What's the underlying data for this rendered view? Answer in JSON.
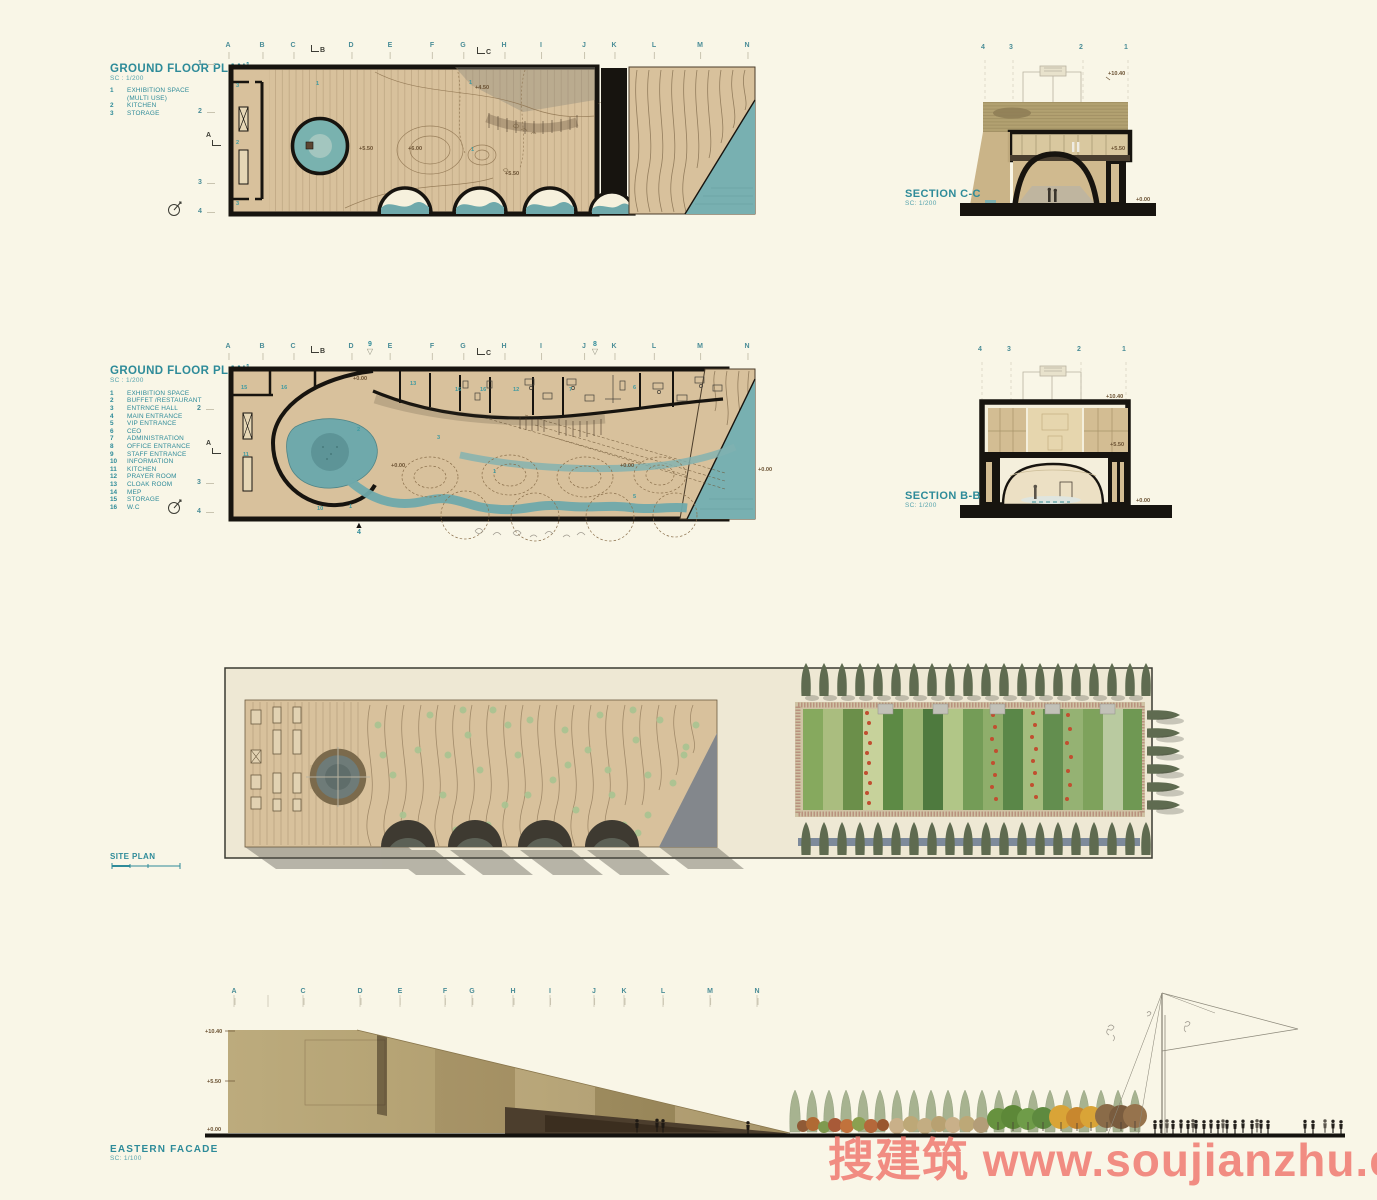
{
  "watermark": {
    "text": "搜建筑 www.soujianzhu.cn",
    "color": "#f0756c"
  },
  "grid": {
    "plan_letters": [
      "A",
      "B",
      "C",
      "D",
      "E",
      "F",
      "G",
      "H",
      "I",
      "J",
      "K",
      "L",
      "M",
      "N"
    ],
    "facade_letters": [
      "A",
      "C",
      "D",
      "E",
      "F",
      "G",
      "H",
      "I",
      "J",
      "K",
      "L",
      "M",
      "N"
    ]
  },
  "plan_upper": {
    "title": "GROUND FLOOR PLAN",
    "title_sup": "1",
    "scale": "SC : 1/200",
    "legend": [
      {
        "num": "1",
        "label": "EXHIBITION SPACE"
      },
      {
        "num": "",
        "label": "(MULTI USE)"
      },
      {
        "num": "2",
        "label": "KITCHEN"
      },
      {
        "num": "3",
        "label": "STORAGE"
      }
    ],
    "rows": [
      "1",
      "2",
      "3",
      "4"
    ],
    "room_labels": [
      "3",
      "2",
      "3",
      "1",
      "1",
      "1"
    ],
    "level_labels": [
      "+5.50",
      "+6.00",
      "+4.50",
      "+5.50"
    ],
    "markers": {
      "a": "A",
      "b": "B",
      "c": "C"
    }
  },
  "section_cc": {
    "title": "SECTION C-C",
    "scale": "SC: 1/200",
    "grid_numbers": [
      "4",
      "3",
      "2",
      "1"
    ],
    "levels": [
      "+10.40",
      "+5.50",
      "+0.00"
    ]
  },
  "plan_ground": {
    "title": "GROUND FLOOR PLAN",
    "title_sup": "1",
    "scale": "SC : 1/200",
    "legend": [
      {
        "num": "1",
        "label": "EXHIBITION SPACE"
      },
      {
        "num": "2",
        "label": "BUFFET /RESTAURANT"
      },
      {
        "num": "3",
        "label": "ENTRNCE HALL"
      },
      {
        "num": "4",
        "label": "MAIN ENTRANCE"
      },
      {
        "num": "5",
        "label": "VIP ENTRANCE"
      },
      {
        "num": "6",
        "label": "CEO"
      },
      {
        "num": "7",
        "label": "ADMINISTRATION"
      },
      {
        "num": "8",
        "label": "OFFICE ENTRANCE"
      },
      {
        "num": "9",
        "label": "STAFF ENTRANCE"
      },
      {
        "num": "10",
        "label": "INFORMATION"
      },
      {
        "num": "11",
        "label": "KITCHEN"
      },
      {
        "num": "12",
        "label": "PRAYER ROOM"
      },
      {
        "num": "13",
        "label": "CLOAK ROOM"
      },
      {
        "num": "14",
        "label": "MEP"
      },
      {
        "num": "15",
        "label": "STORAGE"
      },
      {
        "num": "16",
        "label": "W.C"
      }
    ],
    "rows": [
      "2",
      "3",
      "4"
    ],
    "room_labels": [
      "15",
      "16",
      "13",
      "16",
      "16",
      "12",
      "7",
      "6",
      "11",
      "2",
      "3",
      "10",
      "1",
      "1",
      "5"
    ],
    "level_labels": [
      "+0.00",
      "+0.00",
      "+0.00",
      "+0.00"
    ],
    "markers": {
      "a": "A",
      "b": "B",
      "c": "C",
      "e9": "9",
      "e8": "8",
      "e4": "4"
    }
  },
  "section_bb": {
    "title": "SECTION B-B",
    "scale": "SC: 1/200",
    "grid_numbers": [
      "4",
      "3",
      "2",
      "1"
    ],
    "levels": [
      "+10.40",
      "+5.50",
      "+0.00"
    ]
  },
  "site_plan": {
    "title": "SITE PLAN"
  },
  "facade": {
    "title": "EASTERN FACADE",
    "scale": "SC: 1/100",
    "levels": [
      "+10.40",
      "+5.50",
      "+0.00"
    ]
  }
}
